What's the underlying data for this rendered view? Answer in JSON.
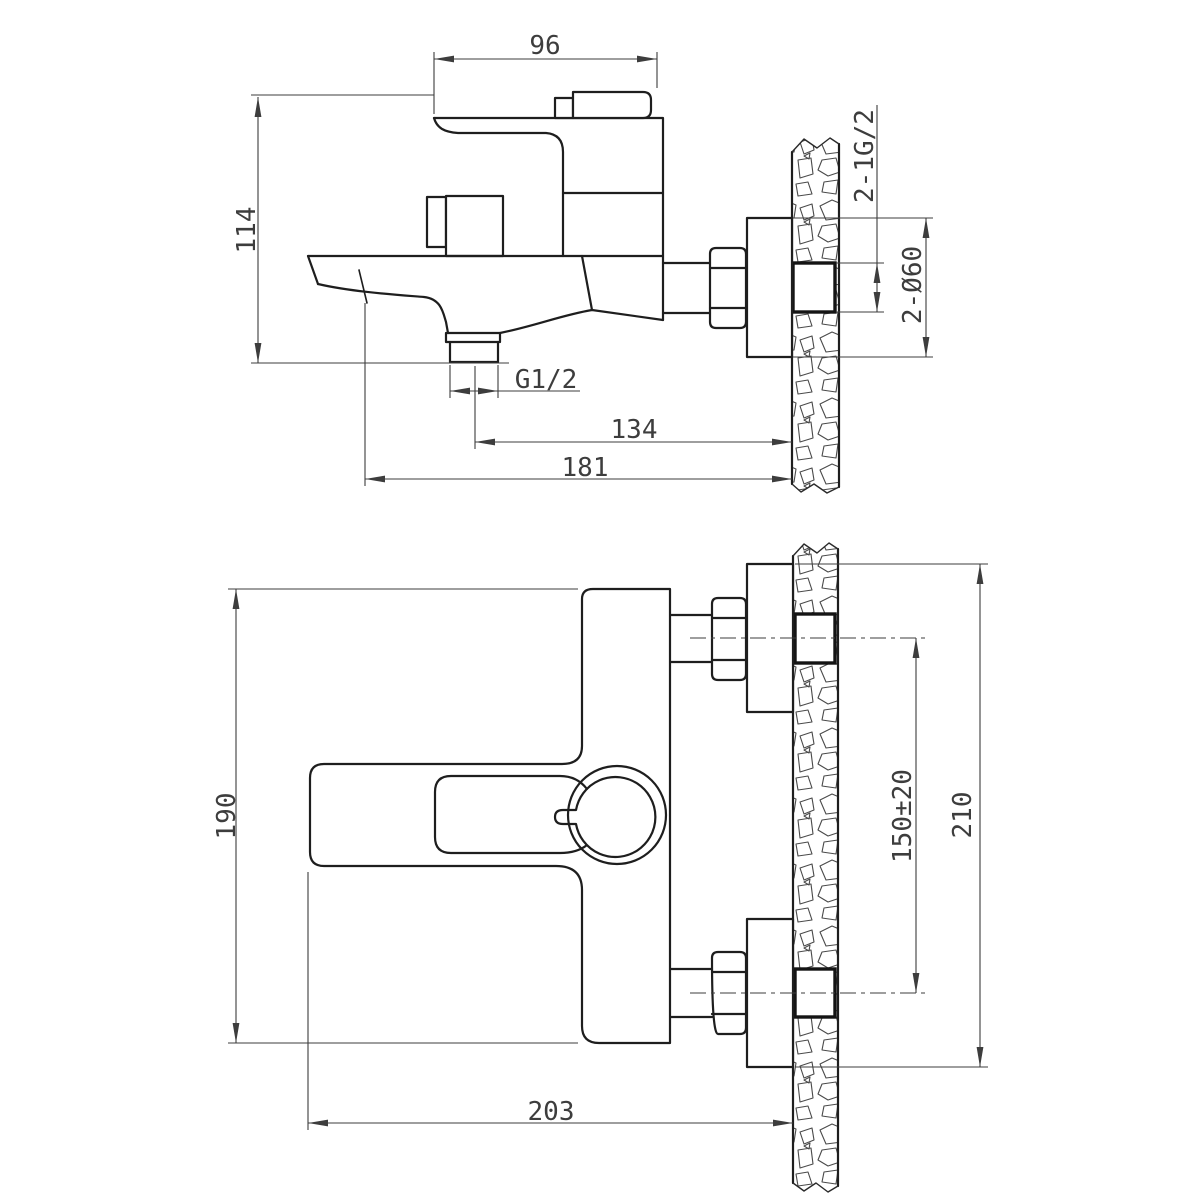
{
  "page": {
    "background": "#ffffff"
  },
  "drawing": {
    "line_color": "#1e1e1e",
    "dim_color": "#3d3d3d",
    "side_view": {
      "dims": {
        "body_width": "96",
        "overall_height": "114",
        "outlet_thread": "G1/2",
        "outlet_center_to_wall": "134",
        "spout_reach": "181",
        "inlet_connections": "2-1G/2",
        "escutcheon_diameter": "2-Ø60"
      }
    },
    "plan_view": {
      "dims": {
        "body_length": "190",
        "inlet_spacing": "150±20",
        "overall_span": "210",
        "wall_projection": "203"
      }
    }
  }
}
